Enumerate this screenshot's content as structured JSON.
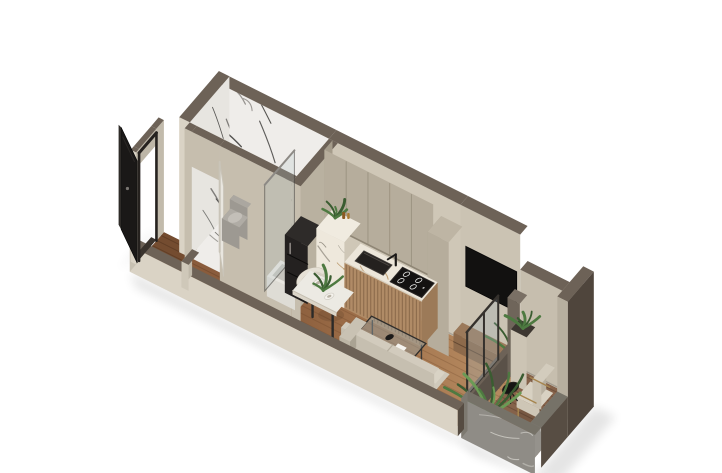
{
  "scene": {
    "kind": "isometric-apartment-floorplan-render",
    "background": "#ffffff",
    "palette": {
      "wallTop": "#6d6257",
      "wallCream": "#dad3c5",
      "wallCreamShade": "#c8c1b2",
      "wallBeige": "#cfc7b7",
      "wallBeigeShade": "#b0a796",
      "bigWall": "#cdc5b5",
      "marble": "#efedea",
      "marbleVein": "#4a4a47",
      "woodLight": "#b5895f",
      "woodMid": "#9a6b46",
      "woodDark": "#7a5033",
      "deck": "#85624a",
      "stone": "#8f8c86",
      "stoneTop": "#767268",
      "cabinetUpper": "#b6ad9c",
      "cabinetWoodFront": "#b08b66",
      "counterMarble": "#ece6da",
      "counterVein": "#b5905e",
      "black": "#1a1817",
      "nicheBlack": "#121110",
      "consoleWood": "#8d6a4b",
      "sofaCream": "#cfc9bb",
      "chairCream": "#d7d1c4",
      "glass": "rgba(158,173,178,0.30)",
      "gold": "#a6854e",
      "plantGreen": "#4e7a41",
      "plantDeep": "#3a5c31",
      "potDark": "#4a443e",
      "doorBlack": "#1a1817",
      "whiteDoor": "#e9e6df"
    },
    "rooms": [
      {
        "name": "bathroom",
        "finish": "white-marble"
      },
      {
        "name": "entry-hall",
        "finish": "dark-wood"
      },
      {
        "name": "kitchen",
        "finish": "wood"
      },
      {
        "name": "living-dining-area",
        "finish": "wood"
      },
      {
        "name": "balcony",
        "finish": "deck-wood"
      }
    ],
    "objects": [
      {
        "name": "bathroom-floor",
        "kind": "marbleFloor",
        "p": {
          "e0": 0,
          "e1": 122,
          "s0": 0,
          "s1": 52
        }
      },
      {
        "name": "shower-tray",
        "kind": "face",
        "p": {
          "pts": [
            [
              78,
              2,
              0.6
            ],
            [
              120,
              2,
              0.6
            ],
            [
              120,
              30,
              0.6
            ],
            [
              78,
              30,
              0.6
            ]
          ],
          "fill": "#d9d6cf"
        }
      },
      {
        "name": "entry-hall-floor",
        "kind": "woodFloor",
        "p": {
          "e0": 0,
          "e1": 126,
          "s0": 52,
          "s1": 85,
          "fill": "#8a5c3c",
          "step": 7,
          "tone": "rgba(70,40,20,0.30)"
        }
      },
      {
        "name": "vestibule-floor",
        "kind": "woodFloor",
        "p": {
          "e0": -38,
          "e1": 0,
          "s0": 40,
          "s1": 85,
          "fill": "#744c30",
          "step": 7,
          "tone": "rgba(50,30,15,0.35)"
        }
      },
      {
        "name": "living-floor",
        "kind": "woodFloor",
        "p": {
          "e0": 118,
          "e1": 342,
          "s0": 0,
          "s1": 85,
          "grad": true,
          "step": 7.8,
          "tone": "rgba(90,55,30,0.28)"
        }
      },
      {
        "name": "balcony-deck",
        "kind": "woodFloor",
        "p": {
          "e0": 342,
          "e1": 412,
          "s0": 0,
          "s1": 93,
          "fill": "#85624a",
          "step": 6.3,
          "tone": "rgba(60,40,25,0.38)"
        }
      },
      {
        "name": "back-wall-bathroom-marble",
        "kind": "wallMarble",
        "p": {
          "e0": -12,
          "e1": 122
        }
      },
      {
        "name": "back-wall-kitchen",
        "kind": "wallSeg",
        "p": {
          "e0": 122,
          "e1": 272,
          "h": 135,
          "fill": "#cfc7b7"
        }
      },
      {
        "name": "back-wall-tv",
        "kind": "wallSeg",
        "p": {
          "e0": 272,
          "e1": 340,
          "h": 135,
          "fill": "#cbc3b3"
        }
      },
      {
        "name": "tv-niche",
        "kind": "face",
        "p": {
          "pts": [
            [
              278,
              0,
              96
            ],
            [
              336,
              0,
              96
            ],
            [
              336,
              0,
              56
            ],
            [
              278,
              0,
              56
            ]
          ],
          "fill": "#121110",
          "stroke": "#060505"
        }
      },
      {
        "name": "media-console",
        "kind": "prism",
        "p": {
          "e0": 274,
          "e1": 338,
          "s0": 0,
          "s1": 14,
          "h0": 0,
          "h1": 18,
          "cw": "#7a5a40",
          "cs": "#8d6a4b",
          "ct": "#9b795a"
        }
      },
      {
        "name": "console-drawer-seam",
        "kind": "line3",
        "p": {
          "a": [
            274,
            14,
            9
          ],
          "b": [
            338,
            14,
            9
          ],
          "stroke": "rgba(60,40,25,0.5)",
          "w": 1
        }
      },
      {
        "name": "console-plant",
        "kind": "tuft",
        "p": {
          "e": 334,
          "s": 7,
          "h": 18,
          "sc": 1.1
        }
      },
      {
        "name": "back-wall-balcony",
        "kind": "wallSeg",
        "p": {
          "e0": 340,
          "e1": 414,
          "h": 100,
          "fill": "#c6beae"
        }
      },
      {
        "name": "west-wall",
        "kind": "westWall",
        "p": {}
      },
      {
        "name": "bathroom-partition-wall",
        "kind": "bathWall",
        "p": {}
      },
      {
        "name": "bathroom-door",
        "kind": "doorPanel",
        "p": {
          "a": [
            40,
            54
          ],
          "b": [
            20,
            32
          ],
          "h": 90,
          "fill": "#e9e6df",
          "edge": "#c9c4b8"
        }
      },
      {
        "name": "bathroom-east-wall",
        "kind": "prism",
        "p": {
          "e0": 122,
          "e1": 132,
          "s0": 0,
          "s1": 60,
          "h0": 0,
          "h1": 135,
          "cw": "#b9b1a0",
          "cs": "#c6beae",
          "ct": "#6d6257"
        }
      },
      {
        "name": "toilet",
        "kind": "toilet",
        "p": {}
      },
      {
        "name": "bathtub",
        "kind": "tub",
        "p": {}
      },
      {
        "name": "shower-glass",
        "kind": "glassFace",
        "p": {
          "pts": [
            [
              84,
              2,
              2
            ],
            [
              84,
              50,
              2
            ],
            [
              84,
              50,
              108
            ],
            [
              84,
              2,
              108
            ]
          ]
        }
      },
      {
        "name": "kitchen-upper-cabinets",
        "kind": "uppers",
        "p": {
          "e0": 126,
          "e1": 250
        }
      },
      {
        "name": "kitchen-tall-cabinet",
        "kind": "prism",
        "p": {
          "e0": 250,
          "e1": 274,
          "s0": 0,
          "s1": 22,
          "h0": 0,
          "h1": 114,
          "cw": "#a79e8d",
          "cs": "#b6ad9c",
          "ct": "#beb5a4"
        }
      },
      {
        "name": "kitchen-black-cabinet",
        "kind": "blackCab",
        "p": {}
      },
      {
        "name": "kitchen-marble-block",
        "kind": "marbleBlock",
        "p": {}
      },
      {
        "name": "counter-decor",
        "kind": "decor",
        "p": {}
      },
      {
        "name": "kitchen-counter",
        "kind": "counter",
        "p": {
          "e0": 158,
          "e1": 246,
          "s1": 26,
          "h": 46
        }
      },
      {
        "name": "kitchen-sink",
        "kind": "sink",
        "p": {}
      },
      {
        "name": "kitchen-faucet",
        "kind": "faucet",
        "p": {}
      },
      {
        "name": "cooktop",
        "kind": "cooktop",
        "p": {}
      },
      {
        "name": "dining-chair-1",
        "kind": "chair",
        "p": {
          "e": 124,
          "s": 31
        }
      },
      {
        "name": "dining-chair-2",
        "kind": "chair",
        "p": {
          "e": 152,
          "s": 39
        }
      },
      {
        "name": "dining-table",
        "kind": "diningTable",
        "p": {}
      },
      {
        "name": "dinner-plate-1",
        "kind": "plate",
        "p": {
          "e": 146,
          "s": 51,
          "r": 6
        }
      },
      {
        "name": "dinner-plate-2",
        "kind": "plate",
        "p": {
          "e": 164,
          "s": 59,
          "r": 5
        }
      },
      {
        "name": "table-centerpiece",
        "kind": "tuft",
        "p": {
          "e": 155,
          "s": 56,
          "h": 38,
          "sc": 0.7
        }
      },
      {
        "name": "coffee-table",
        "kind": "coffeeTable",
        "p": {}
      },
      {
        "name": "sofa",
        "kind": "sofa",
        "p": {}
      },
      {
        "name": "partition-sill",
        "kind": "prism",
        "p": {
          "e0": 336,
          "e1": 342,
          "s0": 0,
          "s1": 85,
          "h0": 0,
          "h1": 34,
          "cw": "#5a5148",
          "cs": "#5f564d",
          "ct": "#6d6257"
        }
      },
      {
        "name": "partition-glass",
        "kind": "partGlass",
        "p": {}
      },
      {
        "name": "partition-column",
        "kind": "prism",
        "p": {
          "e0": 334,
          "e1": 348,
          "s0": 0,
          "s1": 12,
          "h0": 0,
          "h1": 78,
          "cw": "#645a50",
          "cs": "#6f655a",
          "ct": "#7a7065"
        }
      },
      {
        "name": "balcony-planter",
        "kind": "planter",
        "p": {}
      },
      {
        "name": "balcony-east-wall",
        "kind": "eastWall",
        "p": {}
      },
      {
        "name": "balcony-armchair",
        "kind": "armchair",
        "p": {}
      },
      {
        "name": "balcony-side-table",
        "kind": "wireTable",
        "p": {
          "e": 358,
          "s": 41
        }
      },
      {
        "name": "balcony-plant",
        "kind": "plant",
        "p": {
          "e": 348,
          "s": 68
        }
      },
      {
        "name": "parapet-east",
        "kind": "parapet",
        "p": {
          "side": "east"
        }
      },
      {
        "name": "parapet-south",
        "kind": "parapet",
        "p": {
          "side": "south"
        }
      },
      {
        "name": "front-wall",
        "kind": "frontWall",
        "p": {}
      },
      {
        "name": "front-wall-jog",
        "kind": "prism",
        "p": {
          "e0": 14,
          "e1": 22,
          "s0": 68,
          "s1": 85,
          "h0": 0,
          "h1": 26,
          "cw": "#c0b9aa",
          "cs": "#cfc8b9",
          "ct": "#6d6257"
        }
      },
      {
        "name": "entry-vestibule-wall",
        "kind": "vestibule",
        "p": {}
      },
      {
        "name": "entrance-door",
        "kind": "entranceDoor",
        "p": {}
      }
    ]
  }
}
